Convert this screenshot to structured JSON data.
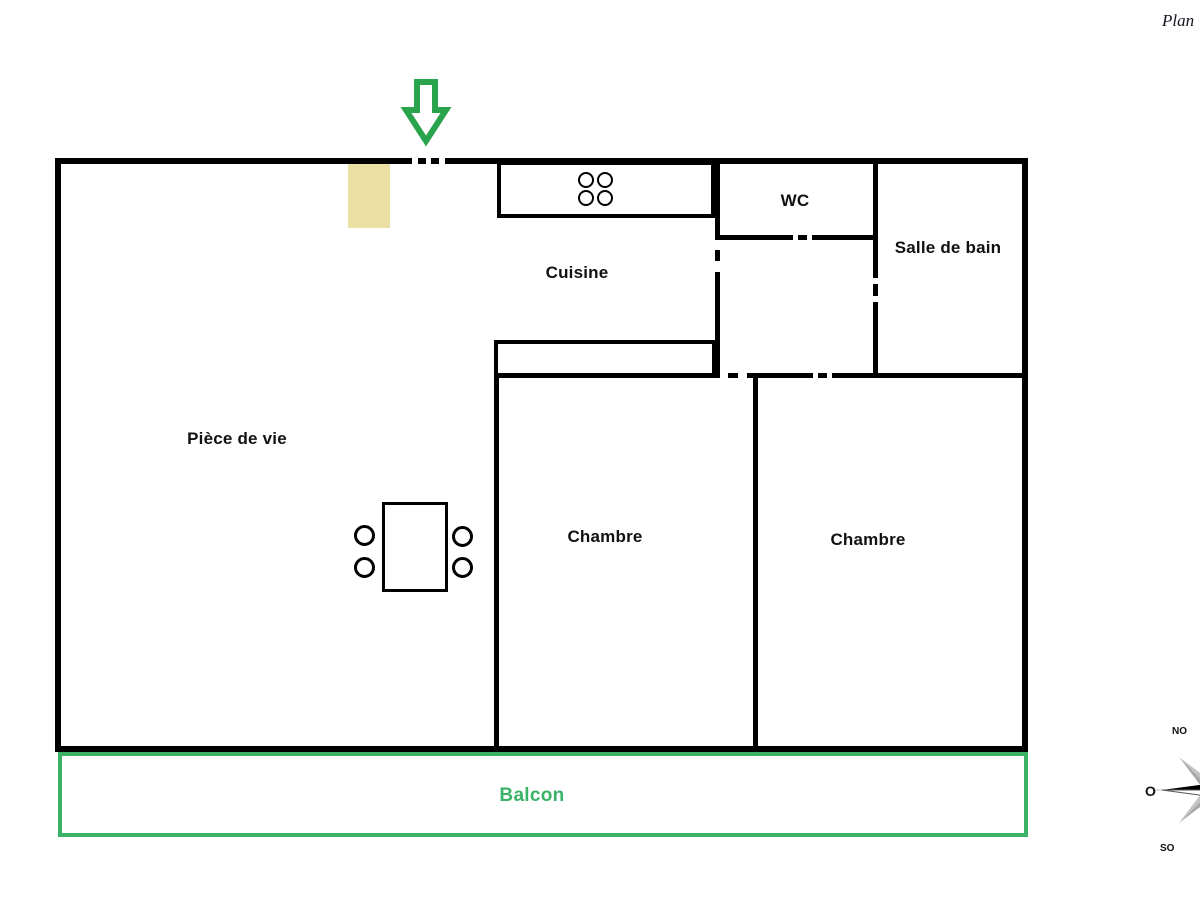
{
  "header": {
    "plan_note": "Plan"
  },
  "rooms": {
    "living": {
      "label": "Pièce de vie"
    },
    "kitchen": {
      "label": "Cuisine"
    },
    "wc": {
      "label": "WC"
    },
    "bathroom": {
      "label": "Salle de bain"
    },
    "bedroom1": {
      "label": "Chambre"
    },
    "bedroom2": {
      "label": "Chambre"
    },
    "balcony": {
      "label": "Balcon"
    }
  },
  "compass": {
    "northwest": "NO",
    "west": "O",
    "southwest": "SO"
  },
  "furniture": {
    "stove_burner_count": 4,
    "dining_chair_count": 4
  },
  "colors": {
    "wall": "#000000",
    "balcony_green": "#3ab267",
    "entrance_arrow_green": "#2aa44c",
    "furniture_beige": "#ecdfa4",
    "compass_dark": "#000000",
    "compass_light": "#c4c4c4"
  }
}
